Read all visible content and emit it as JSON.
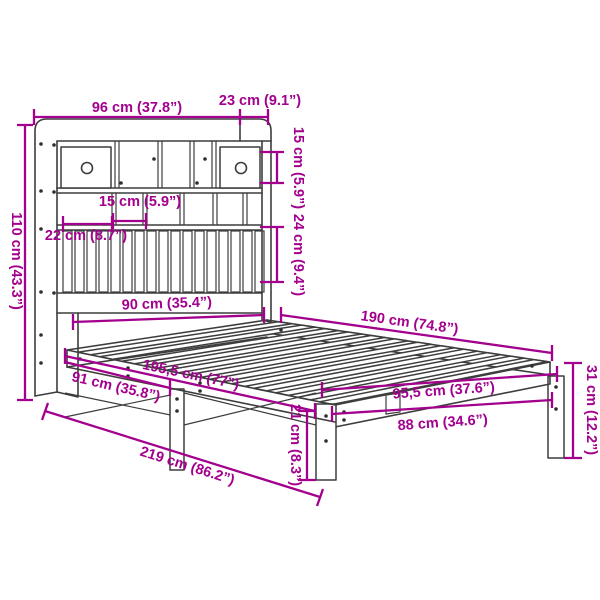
{
  "diagram": {
    "type": "product-dimension-diagram",
    "subject": "bookcase bed with shelf headboard",
    "colors": {
      "dimension_accent": "#a3008e",
      "line_art": "#3d3d3d",
      "background": "#ffffff"
    },
    "labels": {
      "headboard_width": "96 cm (37.8”)",
      "headboard_top_depth": "23 cm (9.1”)",
      "headboard_height": "110 cm (43.3”)",
      "top_shelf_height": "15 cm (5.9”)",
      "compartment_width": "15 cm (5.9”)",
      "left_compartment_width": "22 cm (8.7”)",
      "lower_shelf_height": "24 cm (9.4”)",
      "bed_width": "90 cm (35.4”)",
      "sleeping_length": "190 cm (74.8”)",
      "frame_length": "195,5 cm (77”)",
      "side_rail_length": "91 cm (35.8”)",
      "total_length": "219 cm (86.2”)",
      "foot_outer_width": "95,5 cm (37.6”)",
      "foot_inner_width": "88 cm (34.6”)",
      "under_bed_clearance": "21 cm (8.3”)",
      "foot_end_height": "31 cm (12.2”)"
    }
  }
}
